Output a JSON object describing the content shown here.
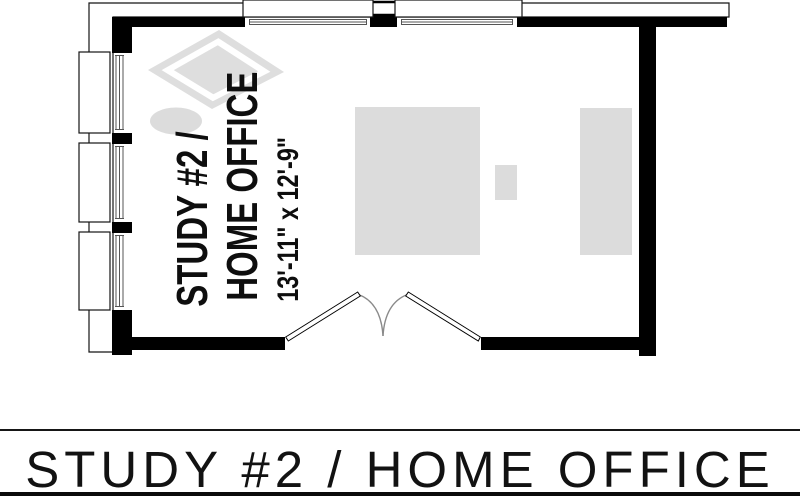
{
  "colors": {
    "wall": "#000000",
    "outline": "#141414",
    "glass_line": "#555555",
    "furniture": "#dcdcdc",
    "rug": "#dedede",
    "door_arc": "#8a8a8a",
    "background": "#ffffff"
  },
  "floor_plan": {
    "room_label": {
      "line1": "STUDY #2 /",
      "line2": "HOME OFFICE",
      "dimensions": "13'-11\" x 12'-9\""
    }
  },
  "caption": {
    "title": "STUDY #2 / HOME OFFICE"
  }
}
